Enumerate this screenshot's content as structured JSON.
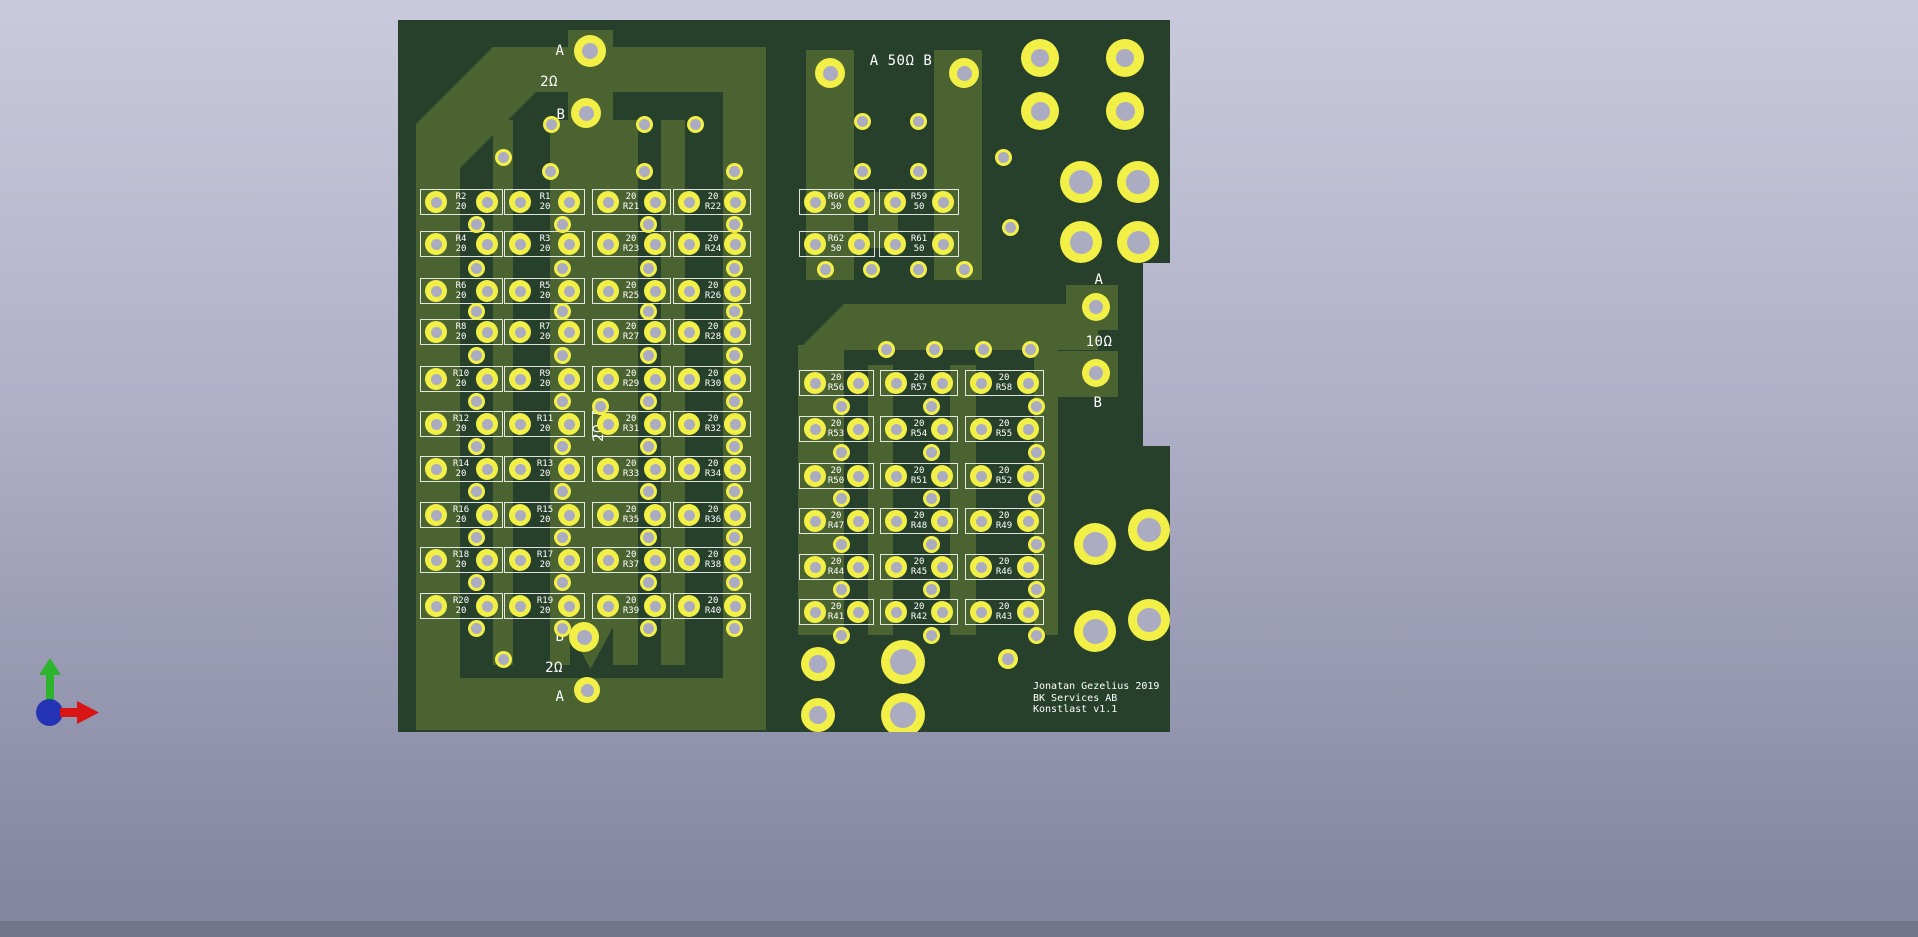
{
  "background": {
    "top": "#c9cadd",
    "bottom": "#8486a0",
    "footer": "#73758b"
  },
  "board": {
    "substrate": "#27402b",
    "copper": "#4b6331",
    "pad_yellow": "#f2f047",
    "hole_grey": "#abacc2",
    "silkscreen": "#ffffff",
    "title_block": {
      "line1": "Jonatan Gezelius 2019",
      "line2": "BK Services AB",
      "line3": "Konstlast v1.1"
    }
  },
  "load_2ohm": {
    "top_port": {
      "a": "A",
      "value": "2Ω",
      "b": "B"
    },
    "bottom_port": {
      "b": "B",
      "value": "2Ω",
      "a": "A"
    },
    "vertical_label": "2Ω B",
    "resistor_value": "20",
    "rows": [
      [
        "R2",
        "R1",
        "R21",
        "R22"
      ],
      [
        "R4",
        "R3",
        "R23",
        "R24"
      ],
      [
        "R6",
        "R5",
        "R25",
        "R26"
      ],
      [
        "R8",
        "R7",
        "R27",
        "R28"
      ],
      [
        "R10",
        "R9",
        "R29",
        "R30"
      ],
      [
        "R12",
        "R11",
        "R31",
        "R32"
      ],
      [
        "R14",
        "R13",
        "R33",
        "R34"
      ],
      [
        "R16",
        "R15",
        "R35",
        "R36"
      ],
      [
        "R18",
        "R17",
        "R37",
        "R38"
      ],
      [
        "R20",
        "R19",
        "R39",
        "R40"
      ]
    ]
  },
  "load_50ohm": {
    "port_label": "A 50Ω B",
    "resistor_value": "50",
    "rows": [
      [
        "R60",
        "R59"
      ],
      [
        "R62",
        "R61"
      ]
    ]
  },
  "load_10ohm": {
    "port": {
      "a": "A",
      "value": "10Ω",
      "b": "B"
    },
    "resistor_value": "20",
    "rows": [
      [
        "R56",
        "R57",
        "R58"
      ],
      [
        "R53",
        "R54",
        "R55"
      ],
      [
        "R50",
        "R51",
        "R52"
      ],
      [
        "R47",
        "R48",
        "R49"
      ],
      [
        "R44",
        "R45",
        "R46"
      ],
      [
        "R41",
        "R42",
        "R43"
      ]
    ]
  },
  "axis_gizmo": {
    "y_axis": "green-up-arrow",
    "x_axis": "red-right-arrow",
    "origin": "blue-sphere"
  }
}
